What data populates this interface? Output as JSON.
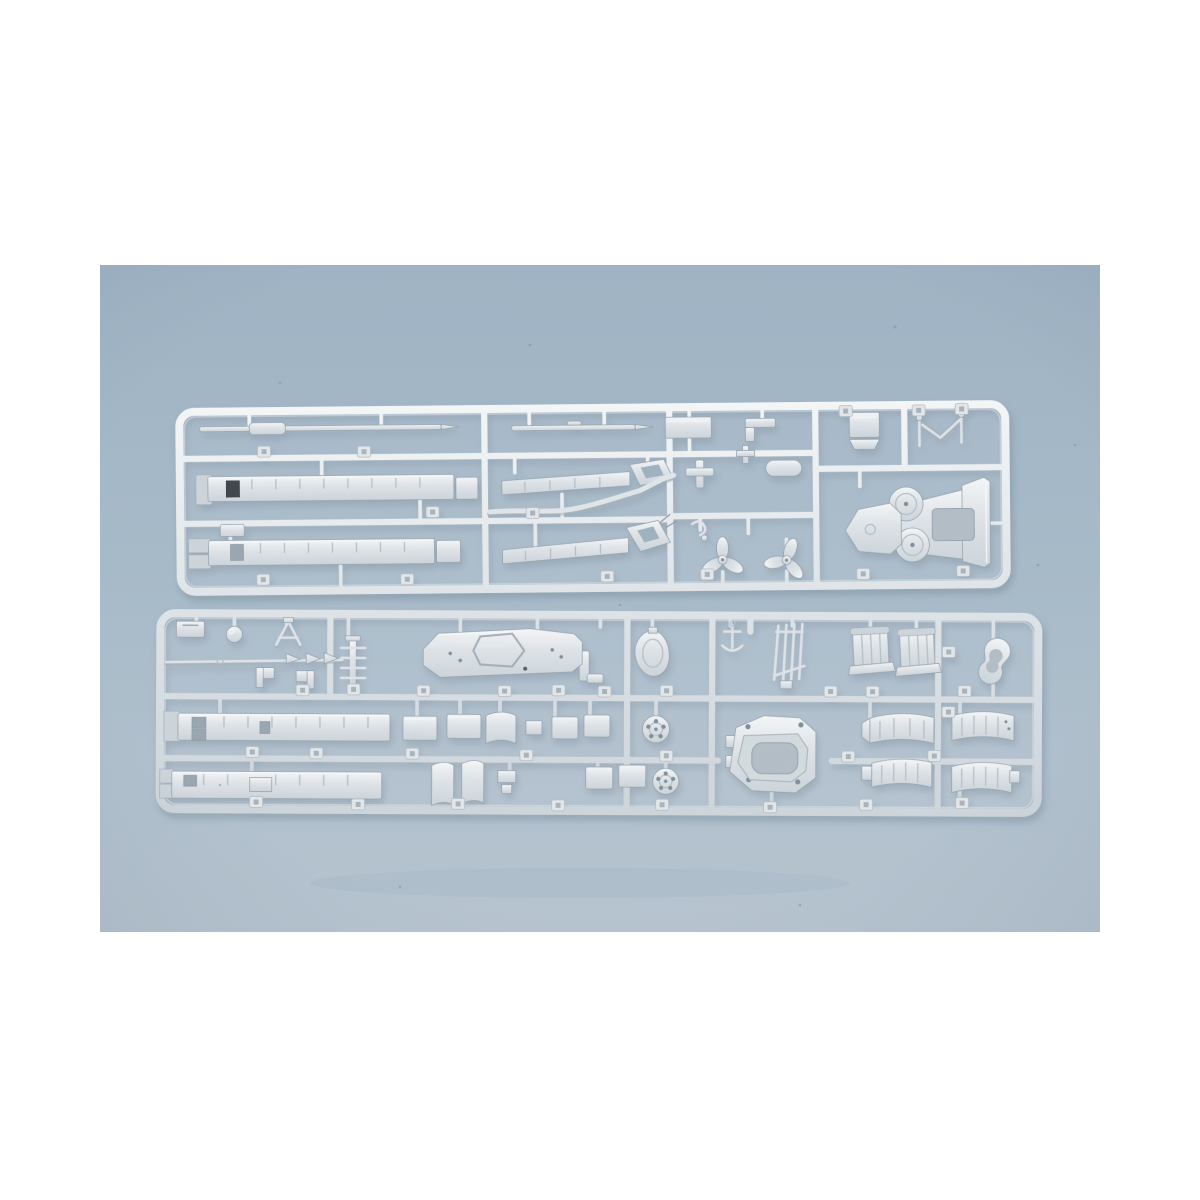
{
  "meta": {
    "type": "photograph",
    "subject": "Product photo of two silver-gray injection-molded plastic model-kit sprues (runners) holding unpainted warship model parts, lying on a blue-gray surface with white letterbox margins",
    "alt": "Two plastic sprues with ship model parts"
  },
  "canvas": {
    "margin_color": "#ffffff",
    "photo_x": 100,
    "photo_y": 265,
    "photo_width": 1000,
    "photo_height": 667
  },
  "colors": {
    "bg_top": "#9fb3c4",
    "bg_mid": "#a7bac8",
    "bg_bottom": "#b7c4d0",
    "plastic_light": "#f3f5f6",
    "plastic_base": "#dde2e6",
    "plastic_mid": "#ccd4da",
    "plastic_outline": "#96a4af",
    "recess": "#b2bdc5",
    "dark_hole": "#40474e",
    "shadow": "#5f7486"
  },
  "sprues": {
    "top": {
      "name": "upper sprue",
      "parts": [
        "mast rod",
        "barrel rod",
        "flat plate",
        "angle bracket",
        "lidded box",
        "v-strut with posts",
        "ribbed superstructure strip with dark hatch",
        "ribbed superstructure strip",
        "crane boom arm upper",
        "crane boom arm lower",
        "s-curved pipe",
        "small fittings",
        "three-blade propeller left",
        "three-blade propeller right",
        "catapult pedestal with twin discs",
        "numbered gate tabs"
      ]
    },
    "bottom": {
      "name": "lower sprue",
      "parts": [
        "corner bracket",
        "round knob",
        "a-frame mast",
        "signal rod with pennants",
        "laddered post",
        "angle brackets",
        "superstructure deck with recess and side arm",
        "conical housing",
        "anchor",
        "boat davit rack",
        "funnel half left",
        "funnel half right",
        "kidney-shaped casing",
        "ribbed hull strip row2",
        "ribbed hull strip row3",
        "small plates",
        "curved bulkhead ribbons",
        "vent grille disc row2",
        "vent grille disc row3",
        "octagonal turret base",
        "curved hull segments",
        "numbered gate tabs"
      ]
    }
  }
}
